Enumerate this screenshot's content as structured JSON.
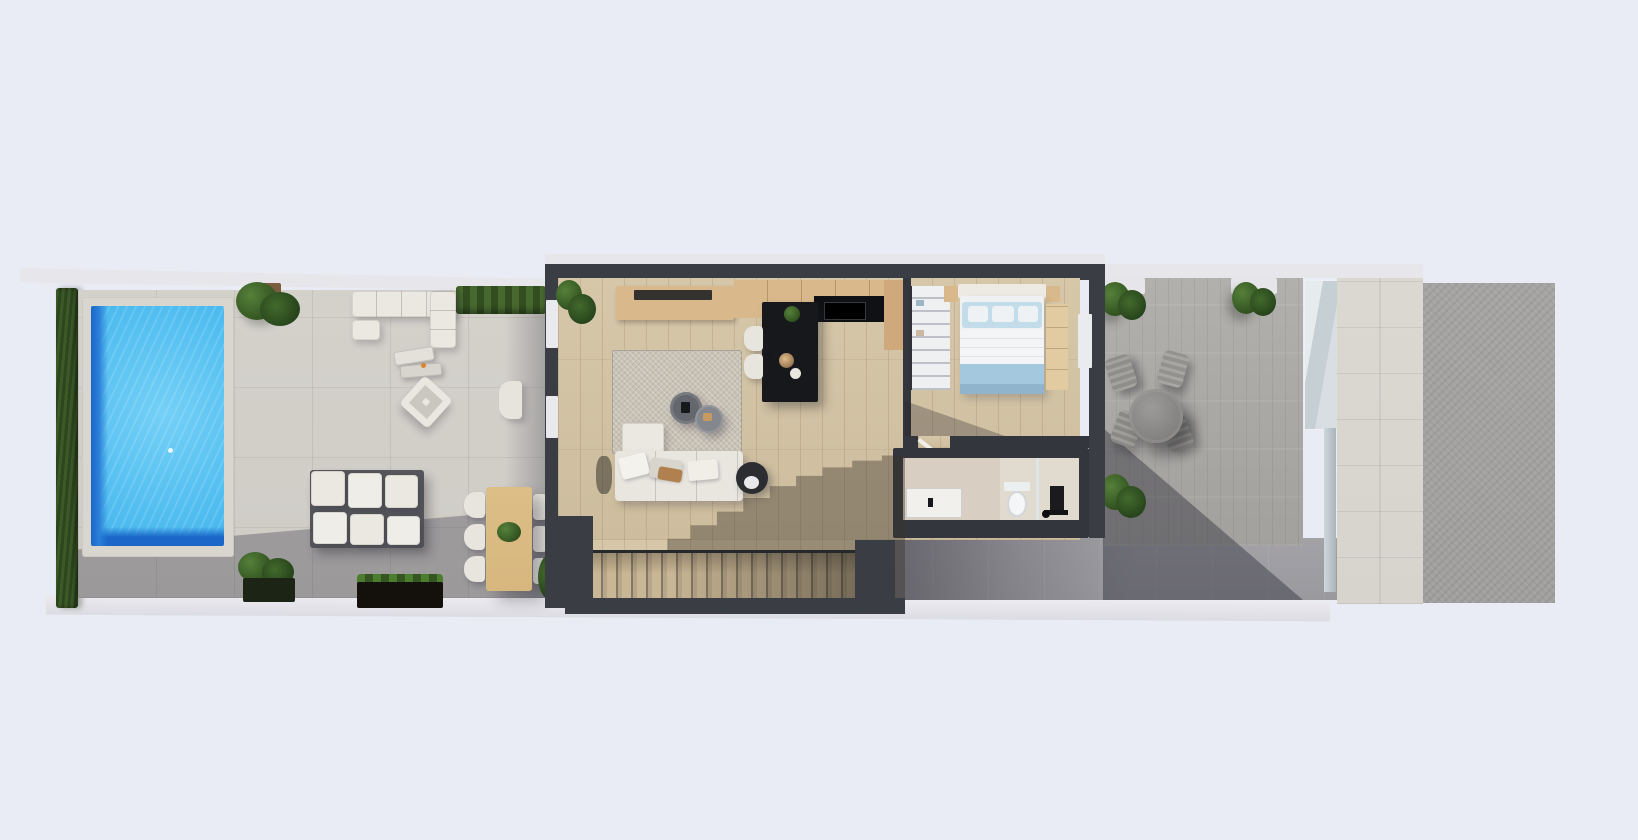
{
  "meta": {
    "title": "Top-down 3D architectural render - single-storey villa plot with pool terrace",
    "render_type": "aerial-3d-floor-plan"
  },
  "palette": {
    "background": "#e9ecf5",
    "wall_coping": "#e7e6ea",
    "house_wall": "#3a3d43",
    "garden_deck": "#cfccc6",
    "hedge_green": "#35511f",
    "pool_coping": "#d9d6d0",
    "pool_water": "#55c0f1",
    "pool_deep": "#1a67c9",
    "furniture_white": "#eae8e1",
    "wood_table": "#d7b77e",
    "planter_green": "#41632e",
    "wood_floor": "#d2c2a3",
    "rug_beige": "#c9c2b6",
    "cabinet_wood": "#d9b98c",
    "island_black": "#17181c",
    "bed_pillow": "#c3dcea",
    "bed_throw": "#a4c8de",
    "linen_white": "#f0f1f2",
    "bath_floor": "#d8cfc2",
    "fixture_black": "#1b1b1d",
    "paver_grey": "#aaa8a5",
    "walkway_grey": "#9a999e",
    "stone_path": "#d7d4cd",
    "gravel_grey": "#a19f9e",
    "glass_blue": "#c6d0d4"
  },
  "scene": {
    "areas": [
      {
        "id": "pool-terrace",
        "label": "pool terrace",
        "features": [
          "swimming-pool",
          "privacy-hedge",
          "sun-loungers",
          "outdoor-corner-sofa",
          "lounge-chair",
          "outdoor-lounge-set",
          "outdoor-dining-table",
          "six-dining-chairs",
          "planter-boxes",
          "potted-plants"
        ]
      },
      {
        "id": "living-kitchen",
        "label": "open-plan living room and kitchen",
        "features": [
          "tv-sideboard",
          "area-rug",
          "round-coffee-tables",
          "l-shaped-sofa",
          "round-side-table",
          "black-kitchen-island",
          "bar-stools",
          "wall-cabinets",
          "staircase",
          "indoor-plant"
        ]
      },
      {
        "id": "bedroom",
        "label": "bedroom",
        "features": [
          "double-bed",
          "blue-bedding",
          "nightstands",
          "open-wardrobe",
          "side-bench",
          "terrace-door"
        ]
      },
      {
        "id": "bathroom",
        "label": "bathroom",
        "features": [
          "vanity-sink",
          "toilet",
          "walk-in-shower",
          "black-shower-column"
        ]
      },
      {
        "id": "rear-terrace",
        "label": "rear paved terrace",
        "features": [
          "round-bistro-table",
          "four-chairs",
          "potted-plants",
          "glass-balustrade"
        ]
      },
      {
        "id": "side-path",
        "label": "side path and plot edge",
        "features": [
          "stone-walkway",
          "gravel-strip",
          "concrete-walkway"
        ]
      }
    ]
  }
}
